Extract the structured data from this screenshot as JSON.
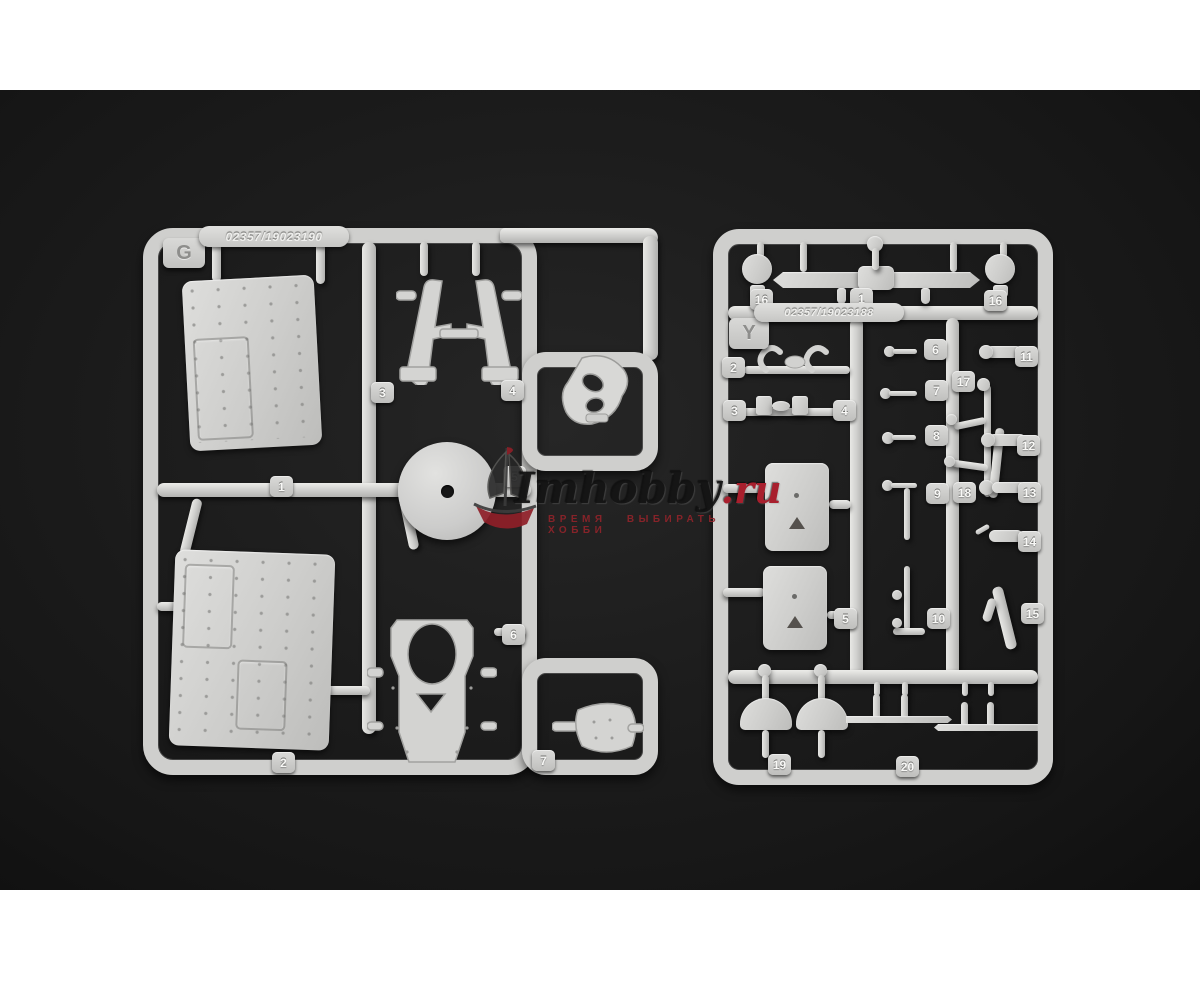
{
  "page": {
    "background": "#ffffff"
  },
  "photo": {
    "background": "#1c1c1c",
    "vignette_edge": "#0f0f0f",
    "plastic_color": "#d2d2d0"
  },
  "watermark": {
    "brand": "Imhobby",
    "domain": ".ru",
    "tagline": "ВРЕМЯ ВЫБИРАТЬ ХОББИ",
    "brand_color": "#1a1a1a",
    "domain_color": "#a81f2d",
    "tagline_color": "#8b2328",
    "logo": "sailing-ship"
  },
  "sprues": {
    "left": {
      "letter": "G",
      "mold_code": "02357/19023190",
      "tags": [
        {
          "label": "1",
          "x": 270,
          "y": 386
        },
        {
          "label": "2",
          "x": 272,
          "y": 662
        },
        {
          "label": "3",
          "x": 371,
          "y": 292
        },
        {
          "label": "4",
          "x": 501,
          "y": 290
        },
        {
          "label": "5",
          "x": 503,
          "y": 376
        },
        {
          "label": "6",
          "x": 502,
          "y": 534
        },
        {
          "label": "7",
          "x": 532,
          "y": 660
        }
      ]
    },
    "right": {
      "letter": "Y",
      "mold_code": "02357/19023188",
      "tags": [
        {
          "label": "16",
          "x": 750,
          "y": 199
        },
        {
          "label": "1",
          "x": 850,
          "y": 198
        },
        {
          "label": "16",
          "x": 984,
          "y": 200
        },
        {
          "label": "2",
          "x": 722,
          "y": 267
        },
        {
          "label": "3",
          "x": 723,
          "y": 310
        },
        {
          "label": "4",
          "x": 833,
          "y": 310
        },
        {
          "label": "6",
          "x": 924,
          "y": 249
        },
        {
          "label": "7",
          "x": 925,
          "y": 290
        },
        {
          "label": "8",
          "x": 925,
          "y": 335
        },
        {
          "label": "9",
          "x": 926,
          "y": 393
        },
        {
          "label": "17",
          "x": 952,
          "y": 281
        },
        {
          "label": "18",
          "x": 953,
          "y": 392
        },
        {
          "label": "11",
          "x": 1015,
          "y": 256
        },
        {
          "label": "12",
          "x": 1017,
          "y": 345
        },
        {
          "label": "13",
          "x": 1018,
          "y": 392
        },
        {
          "label": "14",
          "x": 1018,
          "y": 441
        },
        {
          "label": "15",
          "x": 1021,
          "y": 513
        },
        {
          "label": "5",
          "x": 834,
          "y": 518
        },
        {
          "label": "10",
          "x": 927,
          "y": 518
        },
        {
          "label": "19",
          "x": 768,
          "y": 664
        },
        {
          "label": "20",
          "x": 896,
          "y": 666
        }
      ]
    }
  }
}
